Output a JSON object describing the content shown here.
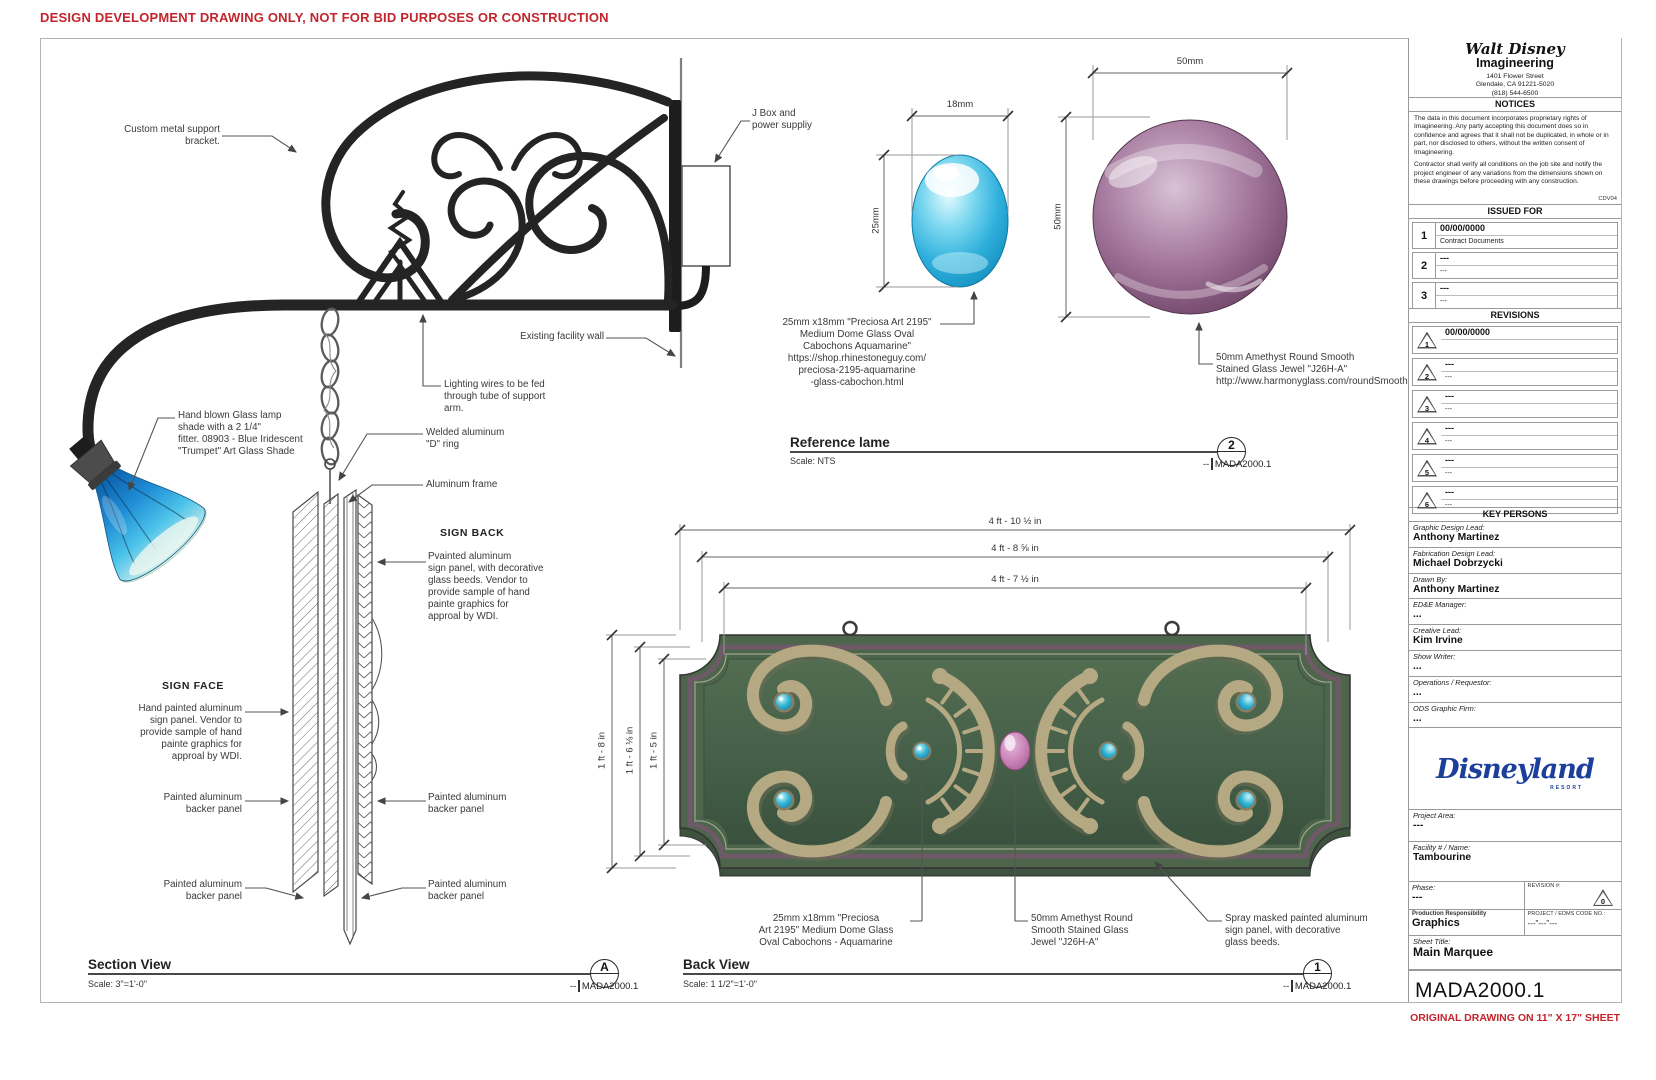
{
  "colors": {
    "accent_red": "#c4242c",
    "sign_green": "#46604a",
    "trim_purple": "#6e5966",
    "ornament_tan": "#b4a982",
    "cab_turquoise": "#2aa9cc",
    "jewel_purple": "#8f5f86",
    "jewel_pink": "#c77fb4",
    "lamp_blue": "#1f8ed6",
    "disney_blue": "#1b3f9b"
  },
  "page": {
    "warning": "DESIGN DEVELOPMENT DRAWING ONLY,  NOT FOR BID PURPOSES OR CONSTRUCTION",
    "sheet_note": "ORIGINAL DRAWING ON 11\" X 17\" SHEET"
  },
  "section_view": {
    "title": "Section View",
    "scale": "Scale: 3\"=1'-0\"",
    "marker": "A",
    "ref_dashes": "--",
    "sheet_ref": "MADA2000.1",
    "headings": {
      "sign_back": "SIGN BACK",
      "sign_face": "SIGN FACE"
    },
    "callouts": {
      "bracket": "Custom metal support\nbracket.",
      "jbox": "J Box and\npower suppliy",
      "wall": "Existing facility wall",
      "wires": "Lighting wires to be fed\nthrough tube of support\narm.",
      "shade": "Hand blown Glass lamp\nshade with a 2 1/4\"\nfitter. 08903 - Blue Iridescent\n\"Trumpet\" Art Glass Shade",
      "dring": "Welded aluminum\n\"D\" ring",
      "frame": "Aluminum frame",
      "sign_back": "Pvainted aluminum\nsign panel, with decorative\nglass beeds. Vendor to\nprovide sample of hand\npainte graphics for\napproal by WDI.",
      "sign_face": "Hand painted aluminum\nsign panel. Vendor to\nprovide sample of hand\npainte graphics for\napproal by WDI.",
      "backer": "Painted aluminum\nbacker panel"
    }
  },
  "reference_view": {
    "title": "Reference lame",
    "scale": "Scale: NTS",
    "marker": "2",
    "ref_dashes": "--",
    "sheet_ref": "MADA2000.1",
    "cabochon": {
      "width": "18mm",
      "height": "25mm",
      "caption": "25mm x18mm \"Preciosa  Art 2195\"\nMedium Dome Glass Oval\nCabochons  Aquamarine\"\nhttps://shop.rhinestoneguy.com/\npreciosa-2195-aquamarine\n-glass-cabochon.html"
    },
    "jewel": {
      "width": "50mm",
      "height": "50mm",
      "caption": "50mm Amethyst Round Smooth\nStained Glass Jewel \"J26H-A\"\nhttp://www.harmonyglass.com/roundSmooth.shtml"
    }
  },
  "back_view": {
    "title": "Back View",
    "scale": "Scale: 1 1/2\"=1'-0\"",
    "marker": "1",
    "ref_dashes": "--",
    "sheet_ref": "MADA2000.1",
    "dims": {
      "w_outer": "4 ft - 10 ½ in",
      "w_mid": "4 ft - 8 ⅝ in",
      "w_inner": "4 ft - 7 ½ in",
      "h_outer": "1 ft - 8 in",
      "h_mid": "1 ft - 6 ⅛ in",
      "h_inner": "1 ft - 5 in"
    },
    "callouts": {
      "cabochon": "25mm x18mm \"Preciosa\nArt 2195\" Medium Dome Glass\nOval Cabochons - Aquamarine",
      "jewel": "50mm Amethyst Round\nSmooth Stained Glass\nJewel \"J26H-A\"",
      "spray": "Spray masked painted aluminum\nsign panel, with decorative\nglass beeds."
    }
  },
  "title_block": {
    "logo_script": "Walt Disney",
    "logo_sub": "Imagineering",
    "address": "1401 Flower Street\nGlendale, CA 91221-5020\n(818) 544-6500",
    "notices_title": "NOTICES",
    "notice1": "The data in this document incorporates proprietary rights of Imagineering. Any party accepting this document does so in confidence and agrees that it shall not be duplicated, in whole or in part, nor disclosed to others, without the written consent of Imagineering.",
    "notice2": "Contractor shall verify all conditions  on the job site and notify the project engineer of any variations from the dimensions shown on these drawings before proceeding with any construction.",
    "notice_code": "CDV04",
    "issued_title": "ISSUED FOR",
    "issued": [
      {
        "num": "1",
        "date": "00/00/0000",
        "desc": "Contract Documents"
      },
      {
        "num": "2",
        "date": "---",
        "desc": "---"
      },
      {
        "num": "3",
        "date": "---",
        "desc": "---"
      }
    ],
    "revisions_title": "REVISIONS",
    "revisions": [
      {
        "num": "1",
        "date": "00/00/0000",
        "desc": ""
      },
      {
        "num": "2",
        "date": "---",
        "desc": "---"
      },
      {
        "num": "3",
        "date": "---",
        "desc": "---"
      },
      {
        "num": "4",
        "date": "---",
        "desc": "---"
      },
      {
        "num": "5",
        "date": "---",
        "desc": "---"
      },
      {
        "num": "6",
        "date": "---",
        "desc": "---"
      }
    ],
    "key_persons_title": "KEY PERSONS",
    "persons": [
      {
        "label": "Graphic Design Lead:",
        "value": "Anthony Martinez"
      },
      {
        "label": "Fabrication Design Lead:",
        "value": "Michael Dobrzycki"
      },
      {
        "label": "Drawn By:",
        "value": "Anthony Martinez"
      },
      {
        "label": "ED&E Manager:",
        "value": "..."
      },
      {
        "label": "Creative Lead:",
        "value": "Kim Irvine"
      },
      {
        "label": "Show Writer:",
        "value": "..."
      },
      {
        "label": "Operations / Requestor:",
        "value": "..."
      },
      {
        "label": "ODS Graphic Firm:",
        "value": "..."
      }
    ],
    "brand": "Disneyland",
    "brand_sub": "RESORT",
    "project_area_label": "Project Area:",
    "project_area": "---",
    "facility_label": "Facility # / Name:",
    "facility": "Tambourine",
    "phase_label": "Phase:",
    "phase": "---",
    "revision_label": "REVISION #:",
    "revision_num": "0",
    "prod_label": "Production Responsibility",
    "prod": "Graphics",
    "code_label": "PROJECT / EDMS CODE NO.:",
    "code": "---\"---\"---",
    "sheet_title_label": "Sheet Title:",
    "sheet_title": "Main Marquee",
    "sheet_number": "MADA2000.1"
  }
}
